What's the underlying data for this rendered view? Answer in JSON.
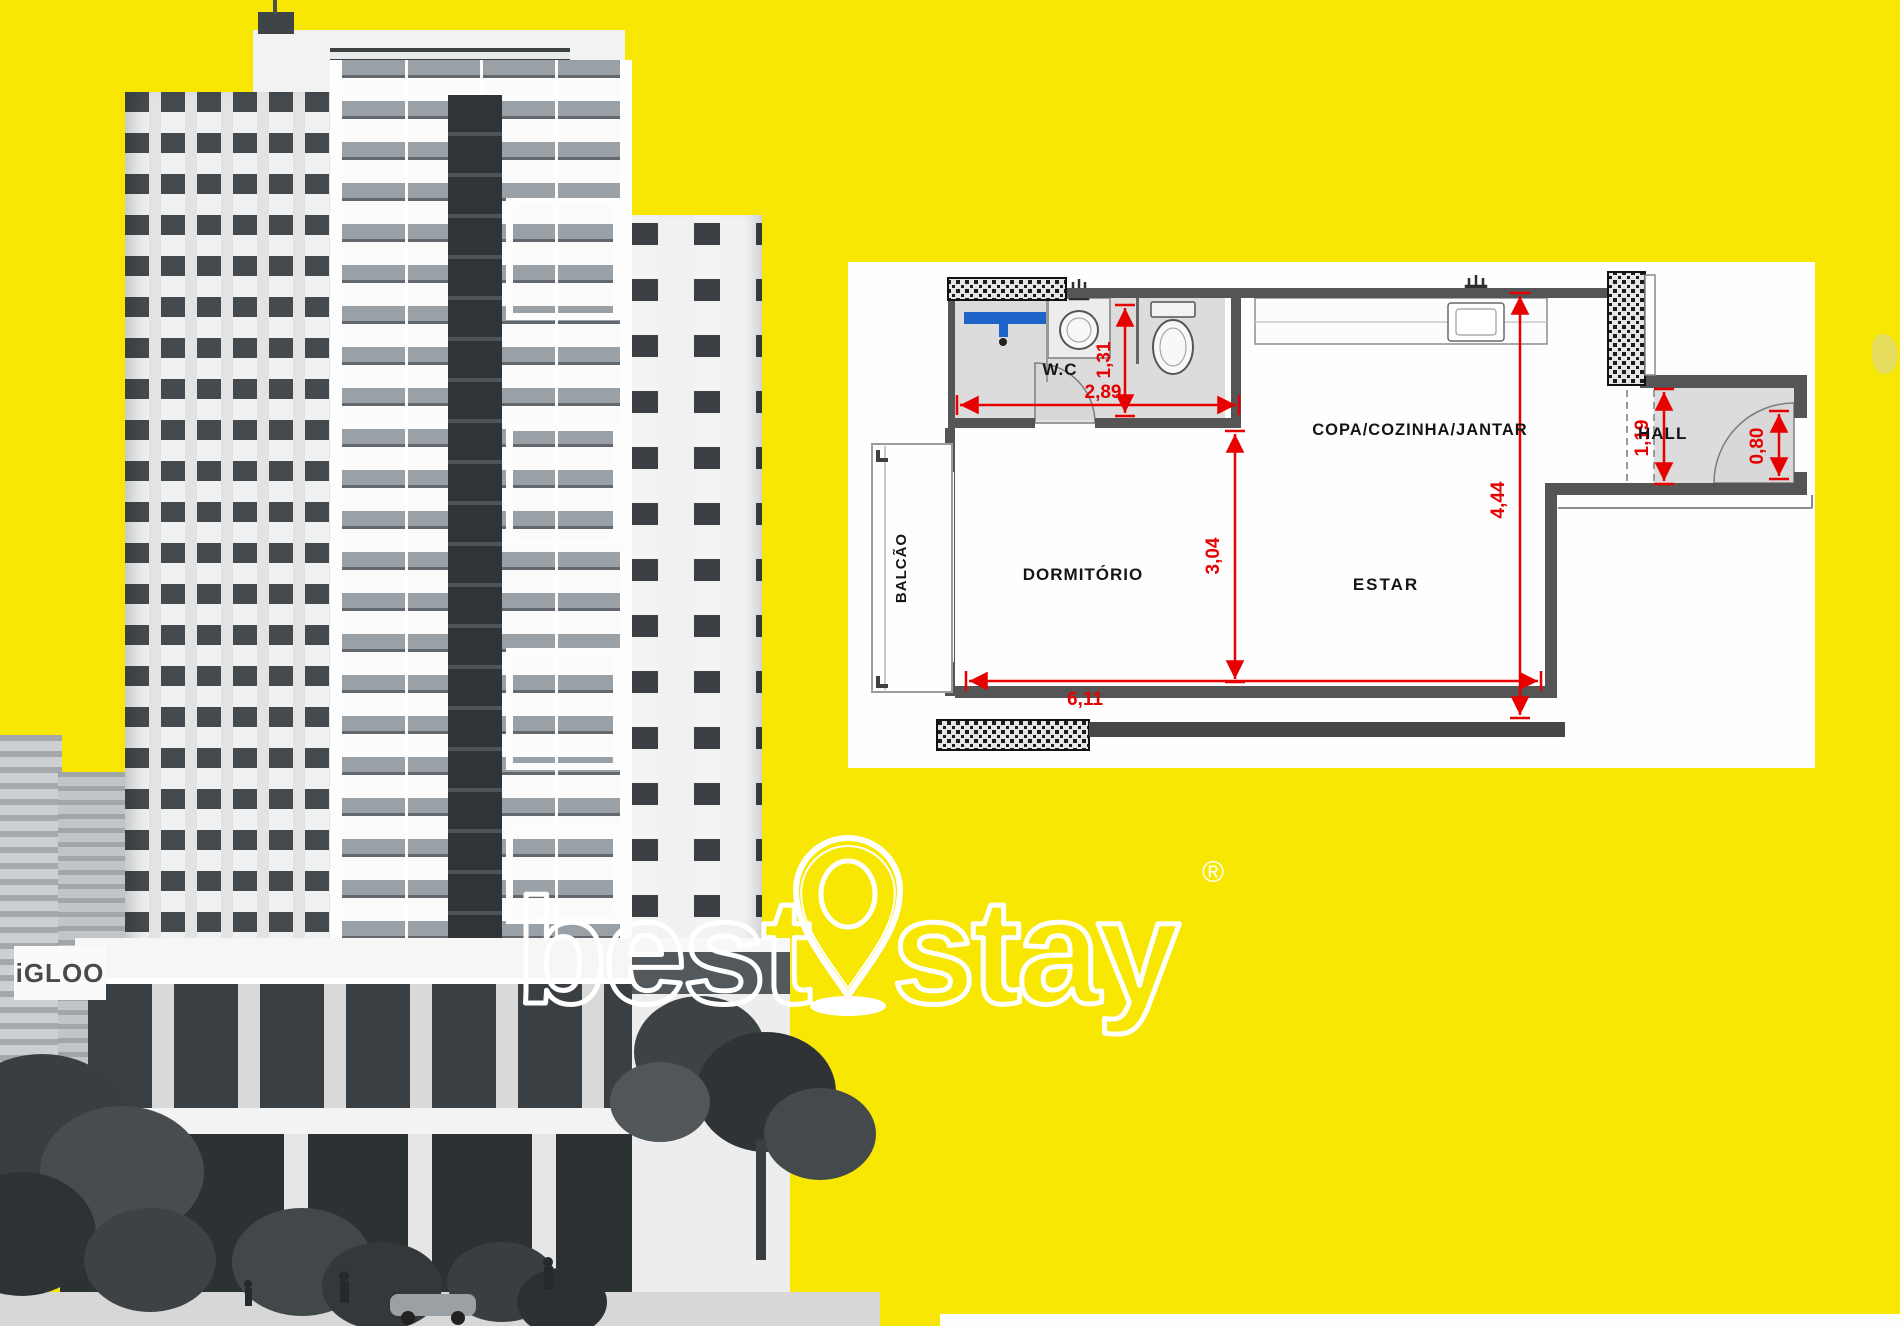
{
  "meta": {
    "background_color": "#f7e703",
    "dimension_color": "#e80000",
    "wall_color": "#555555",
    "wet_floor_color": "#dcdcdc",
    "shower_color": "#1e63c8",
    "plan_background": "#fefefe"
  },
  "building": {
    "sign": "iGLOO"
  },
  "watermark": {
    "brand_left": "best",
    "brand_right": "stay",
    "registered": "®"
  },
  "floor_plan": {
    "rooms": {
      "wc": "W.C",
      "kitchen": "COPA/COZINHA/JANTAR",
      "hall": "HALL",
      "bedroom": "DORMITÓRIO",
      "living": "ESTAR",
      "balcony": "BALCÃO"
    },
    "dimensions": {
      "wc_width": "2,89",
      "wc_depth": "1,31",
      "bedroom_depth": "3,04",
      "kitchen_living_depth": "4,44",
      "hall_depth": "1,19",
      "entry_door_width": "0,80",
      "total_width": "6,11"
    }
  }
}
